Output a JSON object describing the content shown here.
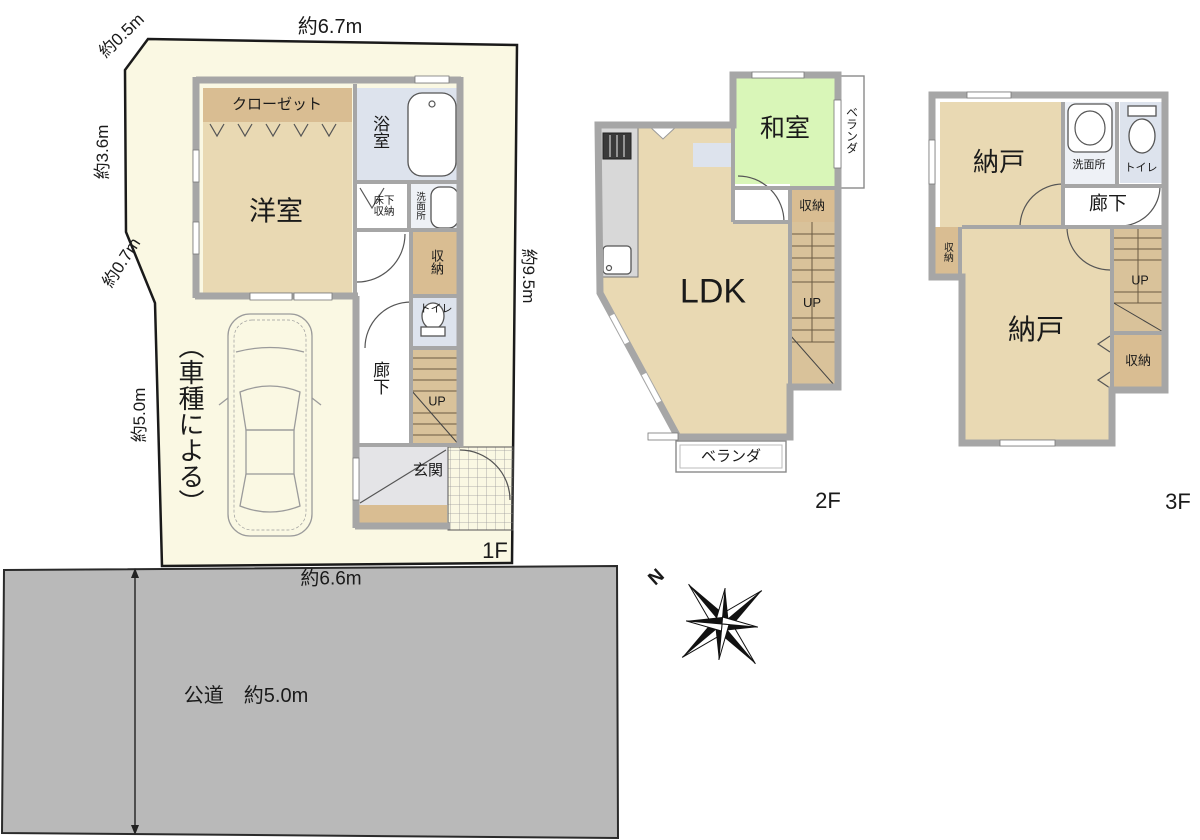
{
  "doc": {
    "type": "floor-plan",
    "title": "間取り図"
  },
  "colors": {
    "c-site": "#faf8e3",
    "c-road": "#b9b9b9",
    "c-wall": "#a6a6a6",
    "c-tan": "#e9d9b3",
    "c-tandark": "#d9bd92",
    "c-stair": "#d9c29a",
    "c-green": "#d9f6b8",
    "c-blue": "#dde3ed",
    "c-wash": "#eef1f6",
    "c-kitchen": "#d8d8d8",
    "c-genkan": "#e4e4e7",
    "c-ink": "#1a1a1a"
  },
  "site": {
    "dim_top": "約6.7m",
    "dim_cut_top_left": "約0.5m",
    "dim_left_upper": "約3.6m",
    "dim_cut_left": "約0.7m",
    "dim_left_lower": "約5.0m",
    "dim_right": "約9.5m",
    "dim_bottom": "約6.6m",
    "parking_note": "（車種による）"
  },
  "road": {
    "label": "公道　約5.0m"
  },
  "compass": {
    "north": "N"
  },
  "floor1": {
    "label": "1F",
    "rooms": {
      "closet": "クローゼット",
      "western": "洋室",
      "bath": "浴室",
      "underfloor_storage": "床下収納",
      "washroom": "洗面所",
      "storage": "収納",
      "toilet": "トイレ",
      "corridor": "廊下",
      "stairs": "UP",
      "entrance": "玄関"
    }
  },
  "floor2": {
    "label": "2F",
    "rooms": {
      "japanese": "和室",
      "veranda_side": "ベランダ",
      "storage": "収納",
      "ldk": "LDK",
      "stairs": "UP",
      "veranda_bottom": "ベランダ"
    }
  },
  "floor3": {
    "label": "3F",
    "rooms": {
      "storeroom_a": "納戸",
      "washroom": "洗面所",
      "toilet": "トイレ",
      "corridor": "廊下",
      "storage_left": "収納",
      "storeroom_b": "納戸",
      "stairs": "UP",
      "storage_right": "収納"
    }
  }
}
